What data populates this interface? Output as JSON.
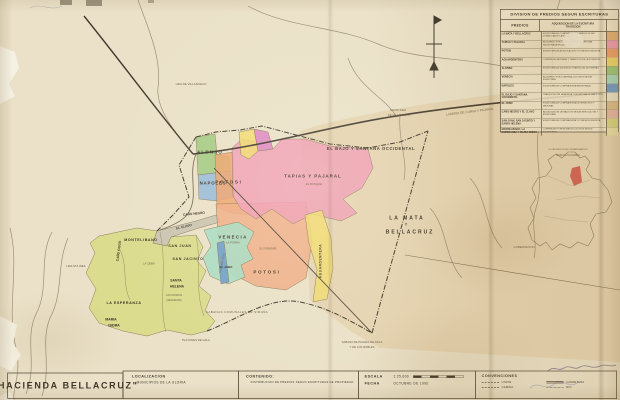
{
  "palette": {
    "paper": "#eae1c8",
    "ink": "#3f382c",
    "faded": "#6e6046",
    "wash": "#ddc394",
    "water": "#8d8068",
    "tear": "#f5f1e3",
    "inset_highlight": "#cf4f46",
    "regions": {
      "green": "#9dc87c",
      "blue": "#92b7dc",
      "blue_dark": "#6f9ccb",
      "orange": "#efa26b",
      "salmon": "#f0ab85",
      "pink": "#f09cb4",
      "magenta": "#de7fc1",
      "yellow": "#f1da6d",
      "yellow_pale": "#ece2ad",
      "teal": "#a9dcc2",
      "yellowgreen": "#d8da84",
      "gray": "#c6c0ae",
      "tan": "#dfbe8a",
      "rose": "#e9b9ab"
    }
  },
  "legend_table": {
    "title": "DIVISION DE PREDIOS SEGUN ESCRITURAS",
    "col_predios": "PREDIOS",
    "col_adq_line1": "ADQUISICION DE LA ESCRITURA",
    "col_adq_line2": "TRADICION",
    "rows": [
      {
        "name": "LA MATA Y BELLACRUZ",
        "desc": "ESCRITURA DE COMPRAVENTA Y TRADICION DEL DOMINIO ANTE LA NOTARIA",
        "color": "#e2b276"
      },
      {
        "name": "TAPIAS Y PAJARAL",
        "desc": "ADQUIRIDO POR COMPRA SEGUN ESCRITURA REGISTRADA EN LA GLORIA",
        "color": "#f09cb4"
      },
      {
        "name": "POTOSI",
        "desc": "ESCRITURA DE ADJUDICACION Y POSESION INSCRITA",
        "color": "#f0a268"
      },
      {
        "name": "AGUARDENTERA",
        "desc": "COMPRA DE MEJORAS Y TRADICION DE LA POSESION",
        "color": "#f1da6d"
      },
      {
        "name": "ALONSO",
        "desc": "ESCRITURA DE SUCESION Y PARTICION DE TIERRAS",
        "color": "#9dc87c"
      },
      {
        "name": "VENECIA",
        "desc": "ADQUIRIDO POR COMPRA A COLONOS SEGUN ESCRITURA",
        "color": "#a9dcc2"
      },
      {
        "name": "NAPOLES",
        "desc": "ESCRITURA DE COMPRAVENTA REGISTRADA",
        "color": "#6f9ccb"
      },
      {
        "name": "EL BAJO Y SANTANA OCCIDENTAL",
        "desc": "TRADICION POR HERENCIA Y ESCRITURA DE PARTICION",
        "color": "#eee6cf"
      },
      {
        "name": "EL JOBO",
        "desc": "ESCRITURA DE COMPRAVENTA DE DERECHOS Y MEJORAS",
        "color": "#dcc08e"
      },
      {
        "name": "CAÑO NEGRO Y EL CLAVO",
        "desc": "ADJUDICACION DE BALDIOS SEGUN RESOLUCION Y ESCRITURA",
        "color": "#e9b9ab"
      },
      {
        "name": "SAN JUAN, SAN JACINTO Y SANTA HELENA",
        "desc": "ESCRITURA DE COMPRAVENTA Y POSESION INSCRITA",
        "color": "#d8da84"
      },
      {
        "name": "MONTELIBANO, LA ESPERANZA Y MARIA ISIDRA",
        "desc": "COMPRA DE POSESIONES A COLONOS SEGUN ESCRITURAS",
        "color": "#ece2ad"
      }
    ]
  },
  "title_block": {
    "map_title": "\"HACIENDA BELLACRUZ\"",
    "localizacion_label": "LOCALIZACION",
    "localizacion_value": "MUNICIPIOS DE LA GLORIA",
    "contenido_label": "CONTENIDO:",
    "contenido_value": "DISTRIBUCION DE PREDIOS SEGUN ESCRITURAS DE PROPIEDAD",
    "escala_label": "ESCALA",
    "escala_value": "1:25.000",
    "fecha_label": "FECHA",
    "fecha_value": "OCTUBRE DE 1990",
    "convenciones_label": "CONVENCIONES",
    "convenciones_items": [
      {
        "label": "LIMITE",
        "style": "dashed"
      },
      {
        "label": "CARRETERA",
        "style": "double"
      },
      {
        "label": "CAMINO",
        "style": "dashed"
      },
      {
        "label": "RIO",
        "style": "dotted"
      }
    ]
  },
  "map": {
    "labels": [
      {
        "t": "ALONSO",
        "x": 210,
        "y": 152,
        "s": 4.4,
        "ls": 1.2,
        "k": "reg",
        "n": "label-region-alonso"
      },
      {
        "t": "NAPOLES",
        "x": 213,
        "y": 183,
        "s": 4.4,
        "ls": 0.8,
        "k": "reg",
        "n": "label-region-napoles"
      },
      {
        "t": "POTOSI",
        "x": 229,
        "y": 182,
        "s": 4.4,
        "ls": 1.8,
        "k": "reg",
        "n": "label-region-potosi-norte"
      },
      {
        "t": "TAPIAS Y PAJARAL",
        "x": 313,
        "y": 176,
        "s": 4.4,
        "ls": 1,
        "k": "reg",
        "n": "label-region-tapias-pajaral"
      },
      {
        "t": "EL BOSQUE",
        "x": 314,
        "y": 184,
        "s": 2.8,
        "k": "bg",
        "n": "label-el-bosque"
      },
      {
        "t": "EL BAJO Y SANTANA OCCIDENTAL",
        "x": 371,
        "y": 149,
        "s": 4.2,
        "ls": 0.6,
        "k": "reg",
        "n": "label-region-el-bajo"
      },
      {
        "t": "LA MATA",
        "x": 407,
        "y": 218,
        "s": 5,
        "ls": 2,
        "k": "reg",
        "n": "label-region-la-mata"
      },
      {
        "t": "Y",
        "x": 406,
        "y": 225,
        "s": 3.4,
        "k": "reg",
        "n": "label-region-la-mata-y"
      },
      {
        "t": "BELLACRUZ",
        "x": 410,
        "y": 232,
        "s": 5,
        "ls": 2,
        "k": "reg",
        "n": "label-region-bellacruz"
      },
      {
        "t": "VENECIA",
        "x": 233,
        "y": 237,
        "s": 4.4,
        "ls": 1.4,
        "k": "reg",
        "n": "label-region-venecia"
      },
      {
        "t": "LA PORFIA",
        "x": 233,
        "y": 243,
        "s": 2.7,
        "k": "bg",
        "n": "label-la-porfia"
      },
      {
        "t": "POTOSI",
        "x": 267,
        "y": 272,
        "s": 4.4,
        "ls": 1.8,
        "k": "reg",
        "n": "label-region-potosi-sur"
      },
      {
        "t": "EL JOBO",
        "x": 226,
        "y": 267,
        "s": 2.9,
        "k": "reg",
        "n": "label-region-el-jobo"
      },
      {
        "t": "AGUARDENTERA",
        "x": 321,
        "y": 261,
        "s": 3.2,
        "r": -90,
        "ls": 0.6,
        "k": "reg",
        "n": "label-region-aguardentera"
      },
      {
        "t": "MONTELIBANO",
        "x": 141,
        "y": 240,
        "s": 3.6,
        "ls": 0.6,
        "k": "reg",
        "n": "label-region-montelibano"
      },
      {
        "t": "SAN JUAN",
        "x": 180,
        "y": 246,
        "s": 3.6,
        "ls": 0.6,
        "k": "reg",
        "n": "label-region-san-juan"
      },
      {
        "t": "SAN JACINTO",
        "x": 188,
        "y": 259,
        "s": 3.6,
        "ls": 0.6,
        "k": "reg",
        "n": "label-region-san-jacinto"
      },
      {
        "t": "SANTA",
        "x": 176,
        "y": 281,
        "s": 3.4,
        "k": "reg",
        "n": "label-region-santa-helena-1"
      },
      {
        "t": "HELENA",
        "x": 177,
        "y": 287,
        "s": 3.4,
        "k": "reg",
        "n": "label-region-santa-helena-2"
      },
      {
        "t": "LA ESPERANZA",
        "x": 124,
        "y": 303,
        "s": 3.6,
        "ls": 0.6,
        "k": "reg",
        "n": "label-region-la-esperanza"
      },
      {
        "t": "MARIA",
        "x": 111,
        "y": 320,
        "s": 3.4,
        "k": "reg",
        "n": "label-region-maria-isidra-1"
      },
      {
        "t": "ISIDRA",
        "x": 114,
        "y": 326,
        "s": 3.4,
        "k": "reg",
        "n": "label-region-maria-isidra-2"
      },
      {
        "t": "CAÑO CIEGO",
        "x": 119,
        "y": 251,
        "s": 3.2,
        "r": -83,
        "k": "reg",
        "n": "label-cano-ciego"
      },
      {
        "t": "LA CEIBA",
        "x": 149,
        "y": 264,
        "s": 2.6,
        "k": "bg",
        "n": "label-la-ceiba"
      },
      {
        "t": "LOS KIOSKOS",
        "x": 174,
        "y": 295,
        "s": 2.4,
        "k": "bg",
        "n": "label-los-kioskos"
      },
      {
        "t": "(VENCELINO)",
        "x": 174,
        "y": 300,
        "s": 2.4,
        "k": "bg",
        "n": "label-vencelino"
      },
      {
        "t": "EL CLAVO",
        "x": 184,
        "y": 227,
        "s": 3.2,
        "r": -13,
        "k": "reg",
        "n": "label-region-el-clavo"
      },
      {
        "t": "CAÑO NEGRO",
        "x": 194,
        "y": 214,
        "s": 3.2,
        "r": -6,
        "k": "reg",
        "n": "label-region-cano-negro"
      },
      {
        "t": "GUARUMO VIEJO",
        "x": 222,
        "y": 263,
        "s": 2.4,
        "r": -78,
        "k": "bg",
        "n": "label-guarumo-viejo"
      },
      {
        "t": "HDA DE VILLANUEVO",
        "x": 191,
        "y": 84,
        "s": 3,
        "k": "bg",
        "n": "label-hda-villanuevo"
      },
      {
        "t": "LADERO DE CURVA Y PAJARAL",
        "x": 470,
        "y": 112,
        "s": 3.2,
        "r": -7,
        "k": "bg",
        "n": "label-ladero-curva"
      },
      {
        "t": "SANTA INES",
        "x": 398,
        "y": 110,
        "s": 2.8,
        "k": "bg",
        "n": "label-santa-ines-1"
      },
      {
        "t": "DE VILLANUEVO",
        "x": 399,
        "y": 115,
        "s": 2.8,
        "k": "bg",
        "n": "label-santa-ines-2"
      },
      {
        "t": "HDA STA INES",
        "x": 76,
        "y": 266,
        "s": 2.8,
        "k": "bg",
        "n": "label-hda-sta-ines"
      },
      {
        "t": "GOBERNACION",
        "x": 524,
        "y": 247,
        "s": 2.8,
        "k": "bg",
        "n": "label-gobernacion"
      },
      {
        "t": "SABANAS COMUNALES DE SIMAÑA",
        "x": 237,
        "y": 312,
        "s": 3,
        "ls": 0.4,
        "k": "bg",
        "n": "label-sabanas-comunales"
      },
      {
        "t": "PLAYONES DE GALA",
        "x": 196,
        "y": 340,
        "s": 2.8,
        "k": "bg",
        "n": "label-playones-gala"
      },
      {
        "t": "SABANA DE PALMAS DE AVILA",
        "x": 362,
        "y": 342,
        "s": 2.8,
        "k": "bg",
        "n": "label-sabana-palmas"
      },
      {
        "t": "Y DE LOS ROBLES",
        "x": 362,
        "y": 347,
        "s": 2.8,
        "k": "bg",
        "n": "label-y-de-los-robles"
      },
      {
        "t": "EL PORVENIR",
        "x": 268,
        "y": 249,
        "s": 2.5,
        "k": "bg",
        "n": "label-el-porvenir"
      },
      {
        "t": "LOCALIZACION DEL DEPARTAMENTO",
        "x": 568,
        "y": 150,
        "s": 2.2,
        "k": "bg",
        "n": "label-inset-title"
      },
      {
        "t": "MAPA DE COLOMBIA",
        "x": 568,
        "y": 155,
        "s": 2.4,
        "k": "bg",
        "n": "label-inset-subtitle"
      }
    ]
  }
}
